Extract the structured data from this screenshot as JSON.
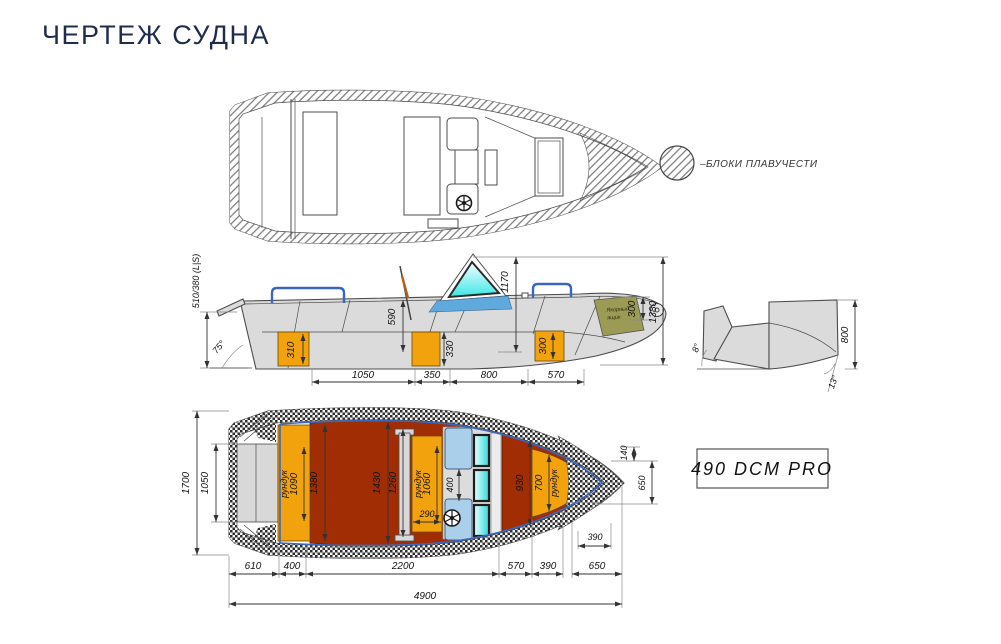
{
  "title": "ЧЕРТЕЖ СУДНА",
  "legend": {
    "label": "–БЛОКИ ПЛАВУЧЕСТИ"
  },
  "badge": {
    "label": "490 DCM PRO"
  },
  "colors": {
    "title": "#1F2C4E",
    "line": "#4C4C4C",
    "hullgray": "#DBDBDB",
    "platform": "#D8D8D8",
    "orange": "#F2A20D",
    "red": "#A12D05",
    "seatblue": "#A9CFEA",
    "railblue": "#3A66BF",
    "cyan": "#35E0E0",
    "olive": "#9B9B55"
  },
  "side": {
    "height_label": "510/380 (L|S)",
    "stern_angle": "75°",
    "d310": "310",
    "d330": "330",
    "d300_block": "300",
    "d590": "590",
    "d1170": "1170",
    "d300_bow": "300",
    "d1380": "1380",
    "anchor_line1": "Якорный",
    "anchor_line2": "ящик",
    "b1050": "1050",
    "b350": "350",
    "b800": "800",
    "b570": "570"
  },
  "transom": {
    "d800": "800",
    "a8": "8°",
    "a13": "13°"
  },
  "plan": {
    "d1700": "1700",
    "d1050": "1050",
    "locker_stern": "рундук",
    "d1090": "1090",
    "d1380": "1380",
    "d1430": "1430",
    "d1260": "1260",
    "locker_mid": "рундук",
    "d1060": "1060",
    "d290": "290",
    "d400": "400",
    "d930": "930",
    "d700": "700",
    "locker_bow": "рундук",
    "d140": "140",
    "d650_bow": "650",
    "d390_bow": "390",
    "b610": "610",
    "b400": "400",
    "b2200": "2200",
    "b570": "570",
    "b390": "390",
    "b650": "650",
    "total": "4900"
  }
}
